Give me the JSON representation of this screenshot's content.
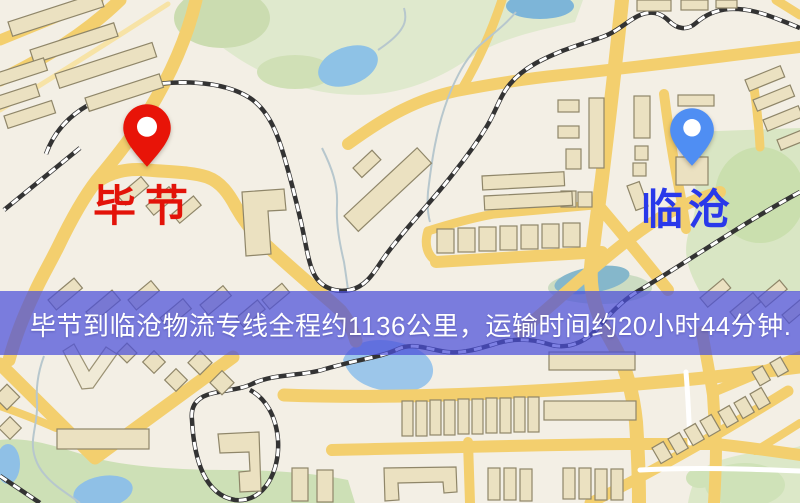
{
  "map": {
    "origin": {
      "label": "毕节",
      "pin_color": "#e81408",
      "label_color": "#e31309"
    },
    "destination": {
      "label": "临沧",
      "pin_color": "#4f8ef3",
      "label_color": "#2939ea"
    }
  },
  "banner": {
    "text": "毕节到临沧物流专线全程约1136公里，运输时间约20小时44分钟.",
    "background": "rgba(75,79,218,0.72)",
    "text_color": "#ffffff"
  },
  "route": {
    "from": "毕节",
    "to": "临沧",
    "distance_km": 1136,
    "duration_hours": 20,
    "duration_minutes": 44
  },
  "colors": {
    "map_background": "#f3efe5",
    "road_yellow": "#f3cf6e",
    "park_green": "#dfe9cd",
    "water_blue": "#92c0e8",
    "railway_dark": "#333333"
  }
}
